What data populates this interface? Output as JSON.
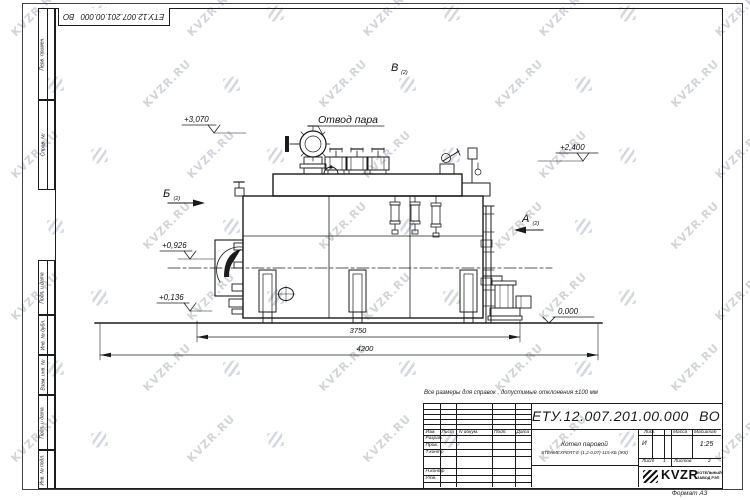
{
  "watermark": {
    "text": "KVZR.RU",
    "color": "#b9bec8"
  },
  "frame": {
    "margin_labels": [
      "Перв. примен.",
      "Справ. №",
      "Подп. и дата",
      "Инв. № дубл.",
      "Взам. инв. №",
      "Подп. и дата",
      "Инв. № подл."
    ]
  },
  "drawing": {
    "steam_outlet_callout": "Отвод пара",
    "elevations": {
      "steam_valve_top": "+3,070",
      "boiler_top": "+2,400",
      "burner_axis": "+0,926",
      "lower_level": "+0,136",
      "ground": "0,000"
    },
    "dimensions": {
      "boiler_length": "3750",
      "overall_length": "4200"
    },
    "views": {
      "a_label": "А",
      "b_label": "Б",
      "v_label": "В",
      "sheet_ref": "(2)"
    }
  },
  "title_block": {
    "note": "Все размеры для справок , допустимые отклонения  ±100  мм",
    "doc_number": "ЕТУ.12.007.201.00.000 ВО",
    "columns": [
      "Изм.",
      "Лист",
      "N докум.",
      "Подп.",
      "Дата"
    ],
    "roles": [
      "Разраб.",
      "Пров.",
      "Т.контр",
      "Н.контр",
      "Утв."
    ],
    "product": {
      "line1": "Котел паровой",
      "line2": "STEAMEXPERT-Е-(1,2-0,07)-115-КБ (ЖК)"
    },
    "lit_header": [
      "Лит.",
      "Масса",
      "Масштаб"
    ],
    "lit_value": "И",
    "scale": "1:25",
    "sheet": {
      "label": "Лист",
      "value": "1",
      "total_label": "Листов",
      "total_value": "2"
    },
    "company": {
      "name": "KVZR",
      "sub1": "КОТЕЛЬНЫЙ",
      "sub2": "ЗАВОД РЭП"
    },
    "format_label": "Формат А3"
  }
}
